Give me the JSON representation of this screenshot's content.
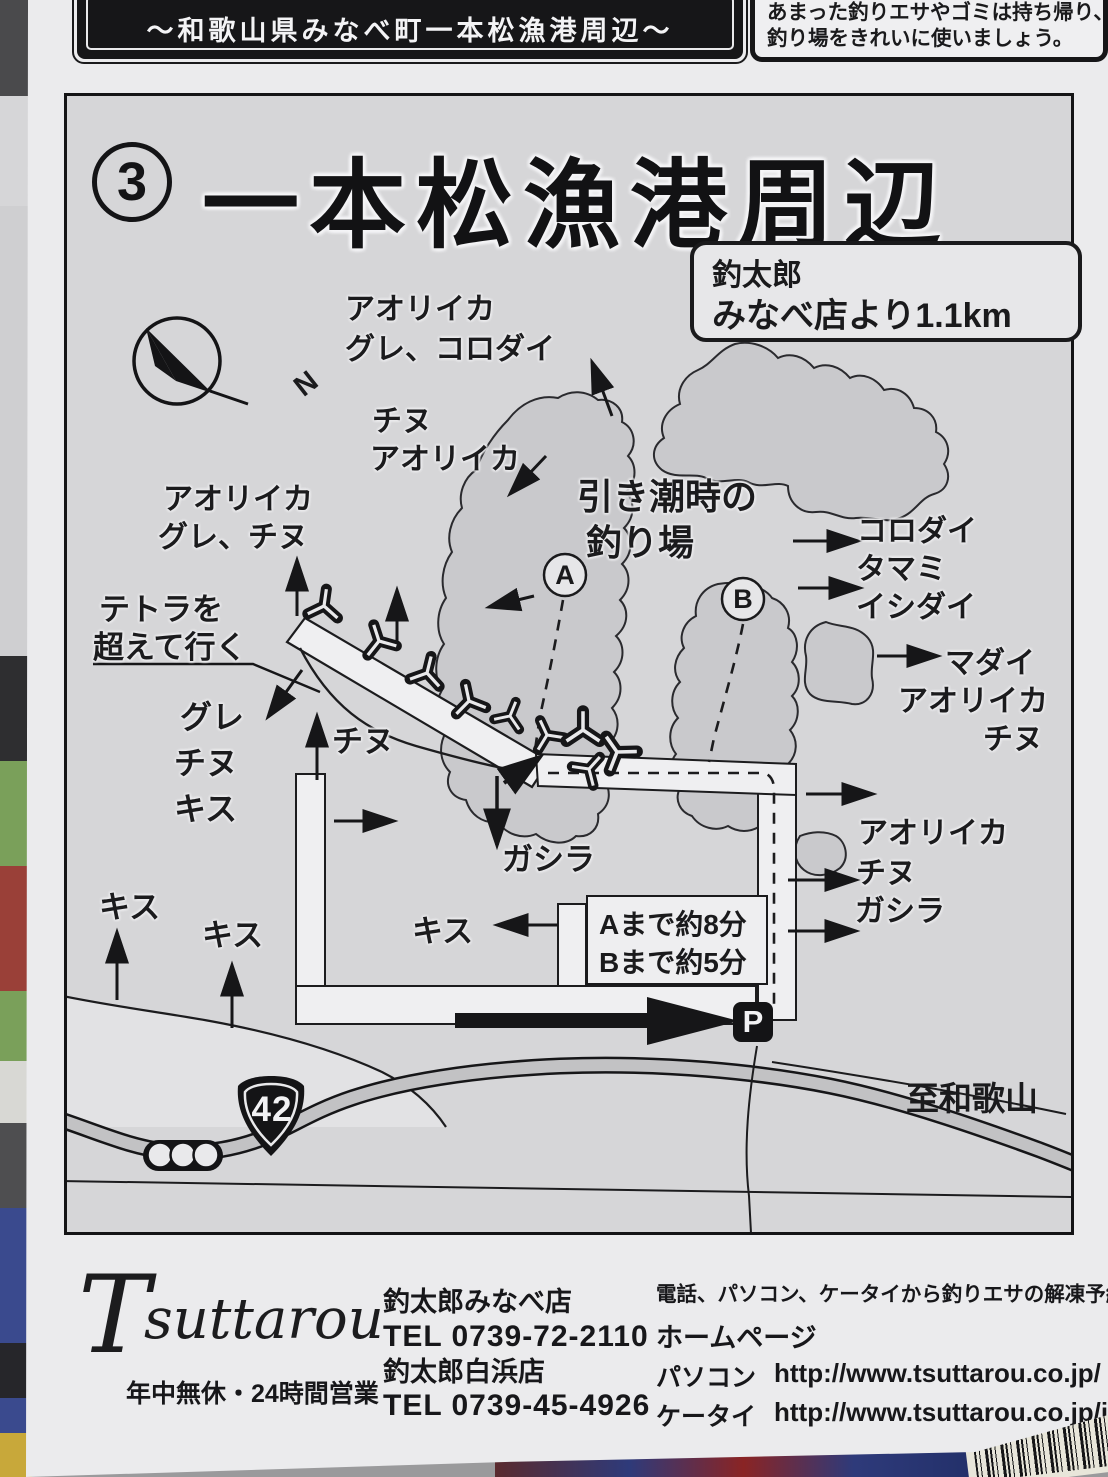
{
  "banner": {
    "text": "〜和歌山県みなべ町一本松漁港周辺〜"
  },
  "notice": {
    "line1": "あまった釣りエサやゴミは持ち帰り、",
    "line2": "釣り場をきれいに使いましょう。"
  },
  "map": {
    "number": "3",
    "title": "一本松漁港周辺",
    "distance": {
      "line1": "釣太郎",
      "line2": "みなべ店より1.1km"
    },
    "compass_n": "N",
    "tide": {
      "line1": "引き潮時の",
      "line2": "釣り場"
    },
    "marker_a": "A",
    "marker_b": "B",
    "labels": {
      "nw1_l1": "アオリイカ",
      "nw1_l2": "グレ、コロダイ",
      "nw2_l1": "チヌ",
      "nw2_l2": "アオリイカ",
      "w1_l1": "アオリイカ",
      "w1_l2": "グレ、チヌ",
      "tetra_l1": "テトラを",
      "tetra_l2": "超えて行く",
      "w2_l1": "グレ",
      "w2_l2": "チヌ",
      "w2_l3": "キス",
      "pier_chinu": "チヌ",
      "gashira": "ガシラ",
      "kisu_left1": "キス",
      "kisu_left2": "キス",
      "kisu_center": "キス",
      "e1_l1": "コロダイ",
      "e1_l2": "タマミ",
      "e1_l3": "イシダイ",
      "e2_l1": "マダイ",
      "e2_l2": "アオリイカ",
      "e2_l3": "チヌ",
      "e3_l1": "アオリイカ",
      "e3_l2": "チヌ",
      "e3_l3": "ガシラ"
    },
    "time_box": {
      "line1": "Aまで約8分",
      "line2": "Bまで約5分"
    },
    "parking": "P",
    "route": "42",
    "to_wakayama": "至和歌山"
  },
  "footer": {
    "logo": "suttarou",
    "logo_initial": "T",
    "logo_sub": "年中無休・24時間営業",
    "shop1_name": "釣太郎みなべ店",
    "shop1_tel": "TEL 0739-72-2110",
    "shop2_name": "釣太郎白浜店",
    "shop2_tel": "TEL 0739-45-4926",
    "note": "電話、パソコン、ケータイから釣りエサの解凍予約が出来ます。",
    "homepage": "ホームページ",
    "pc_label": "パソコン",
    "pc_url": "http://www.tsuttarou.co.jp/",
    "mobile_label": "ケータイ",
    "mobile_url": "http://www.tsuttarou.co.jp/i/"
  }
}
